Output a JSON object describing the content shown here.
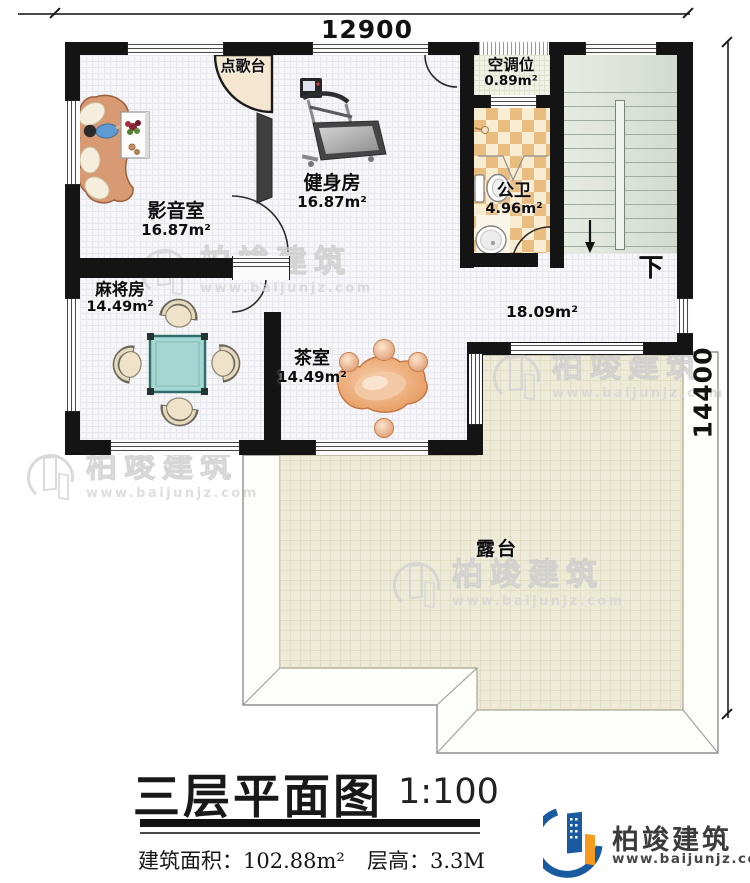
{
  "dimensions": {
    "top": "12900",
    "right": "14400"
  },
  "rooms": {
    "karaoke": {
      "name": "点歌台"
    },
    "media": {
      "name": "影音室",
      "area": "16.87m²"
    },
    "gym": {
      "name": "健身房",
      "area": "16.87m²"
    },
    "ac": {
      "name": "空调位",
      "area": "0.89m²"
    },
    "bath": {
      "name": "公卫",
      "area": "4.96m²"
    },
    "mahjong": {
      "name": "麻将房",
      "area": "14.49m²"
    },
    "tea": {
      "name": "茶室",
      "area": "14.49m²"
    },
    "hall": {
      "area": "18.09m²"
    },
    "terrace": {
      "name": "露台"
    },
    "stairs": {
      "down": "下"
    }
  },
  "titleblock": {
    "title": "三层平面图",
    "scale": "1:100",
    "area_label": "建筑面积：",
    "area_value": "102.88m²",
    "floor_height_label": "层高：",
    "floor_height_value": "3.3M"
  },
  "logo": {
    "company": "柏竣建筑",
    "website": "www.baijunjz.com"
  },
  "watermark": {
    "company": "柏竣建筑",
    "website": "www.baijunjz.com"
  },
  "colors": {
    "wall": "#141414",
    "terrace_tile": "#edead8",
    "stair_green": "#dce3d9",
    "bath_tile_dark": "#e9bc80",
    "bath_tile_light": "#f8ecd2",
    "logo_blue": "#1a5aa0",
    "logo_orange": "#f59a1e"
  }
}
